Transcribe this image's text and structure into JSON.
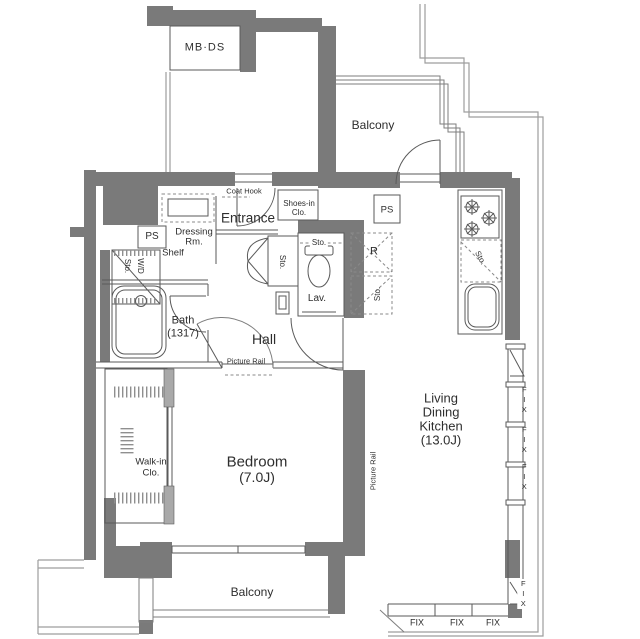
{
  "colors": {
    "wall_fill": "#7a7a7a",
    "line": "#5a5a5a"
  },
  "labels": {
    "mbds": "MB·DS",
    "balcony_top": "Balcony",
    "coat_hook": "Coat Hook",
    "entrance": "Entrance",
    "shoes1": "Shoes-in",
    "shoes2": "Clo.",
    "ps_kitchen": "PS",
    "dressing1": "Dressing",
    "dressing2": "Rm.",
    "shelf": "Shelf",
    "ps_left": "PS",
    "sto_wd_sto": "Sto.",
    "sto_wd_wd": "W/D",
    "bath1": "Bath",
    "bath2": "(1317)",
    "hall": "Hall",
    "sto_hall": "Sto.",
    "sto_lav": "Sto.",
    "lav": "Lav.",
    "fridge": "R",
    "sto_fridge": "Sto.",
    "sto_counter": "Sto.",
    "picture_rail": "Picture Rail",
    "walkin1": "Walk-in",
    "walkin2": "Clo.",
    "bedroom1": "Bedroom",
    "bedroom2": "(7.0J)",
    "ldk1": "Living",
    "ldk2": "Dining",
    "ldk3": "Kitchen",
    "ldk4": "(13.0J)",
    "balcony_bottom": "Balcony",
    "fix": "FIX"
  }
}
